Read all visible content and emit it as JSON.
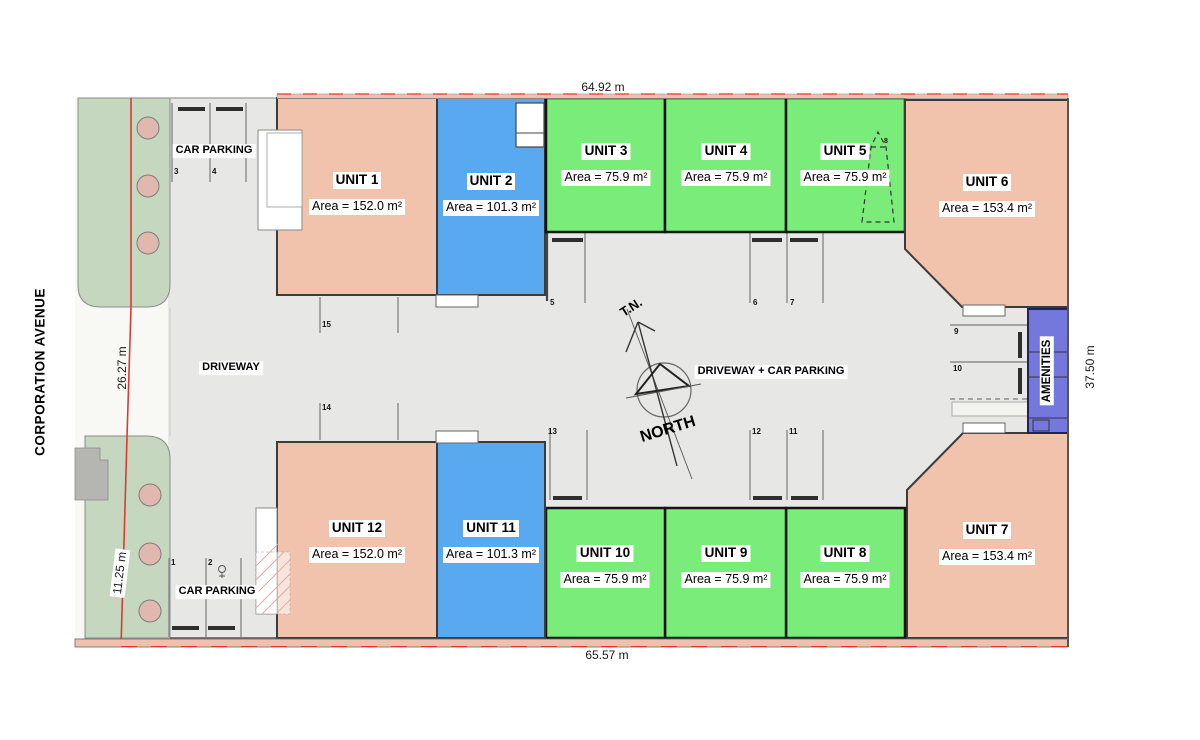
{
  "street": {
    "name": "CORPORATION AVENUE"
  },
  "dimensions": {
    "top": "64.92 m",
    "bottom": "65.57 m",
    "left_upper": "26.27 m",
    "left_lower": "11.25 m",
    "right": "37.50 m"
  },
  "labels": {
    "driveway": "DRIVEWAY",
    "driveway_car_parking": "DRIVEWAY + CAR PARKING",
    "car_parking_top": "CAR PARKING",
    "car_parking_bottom": "CAR PARKING",
    "amenities": "AMENITIES"
  },
  "compass": {
    "true_north": "T.N.",
    "north": "NORTH"
  },
  "units": [
    {
      "name": "UNIT 1",
      "area": "Area = 152.0 m²"
    },
    {
      "name": "UNIT 2",
      "area": "Area = 101.3 m²"
    },
    {
      "name": "UNIT 3",
      "area": "Area = 75.9 m²"
    },
    {
      "name": "UNIT 4",
      "area": "Area = 75.9 m²"
    },
    {
      "name": "UNIT 5",
      "area": "Area = 75.9 m²"
    },
    {
      "name": "UNIT 6",
      "area": "Area = 153.4 m²"
    },
    {
      "name": "UNIT 7",
      "area": "Area = 153.4 m²"
    },
    {
      "name": "UNIT 8",
      "area": "Area = 75.9 m²"
    },
    {
      "name": "UNIT 9",
      "area": "Area = 75.9 m²"
    },
    {
      "name": "UNIT 10",
      "area": "Area = 75.9 m²"
    },
    {
      "name": "UNIT 11",
      "area": "Area = 101.3 m²"
    },
    {
      "name": "UNIT 12",
      "area": "Area = 152.0 m²"
    }
  ],
  "parking_spaces": [
    {
      "label": "1"
    },
    {
      "label": "2"
    },
    {
      "label": "3"
    },
    {
      "label": "4"
    },
    {
      "label": "5"
    },
    {
      "label": "6"
    },
    {
      "label": "7"
    },
    {
      "label": "8"
    },
    {
      "label": "9"
    },
    {
      "label": "10"
    },
    {
      "label": "11"
    },
    {
      "label": "12"
    },
    {
      "label": "13"
    },
    {
      "label": "14"
    },
    {
      "label": "15"
    }
  ],
  "colors": {
    "unit_pink": "#f1c3ac",
    "unit_blue": "#58a9ef",
    "unit_green": "#79ec79",
    "amenities_purple": "#7477dc",
    "landscape_green": "#c6d7c0",
    "tree_pink": "#e0b8af",
    "pavement_gray": "#e7e8e5",
    "entrance_white": "#f8f8f5",
    "boundary_red": "#d93b32",
    "wall_salmon": "#efc0ab"
  }
}
